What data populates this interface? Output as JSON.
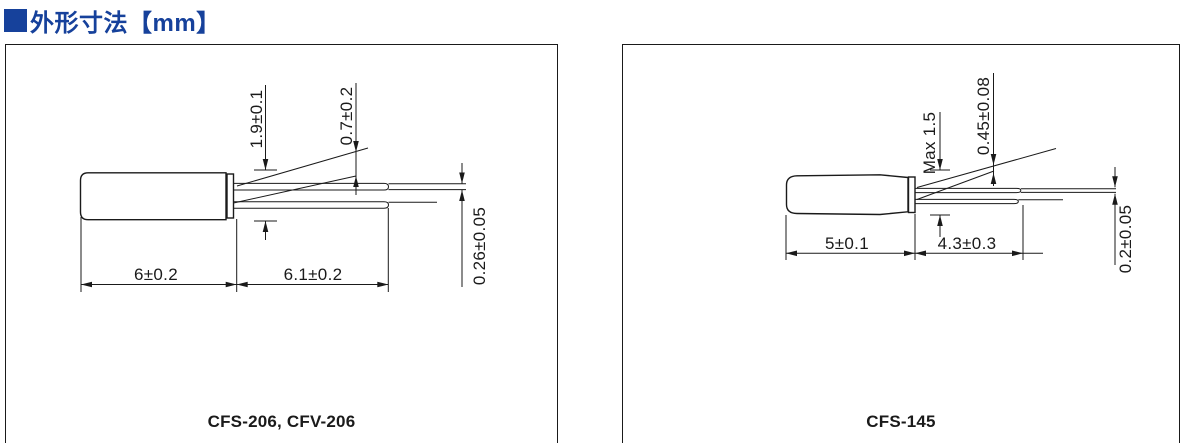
{
  "header": {
    "title": "外形寸法【mm】",
    "accent_color": "#16419b"
  },
  "icons": {
    "section_marker": "filled-blue-square"
  },
  "panels": [
    {
      "caption": "CFS-206, CFV-206",
      "dims": {
        "seal_height": "1.9±0.1",
        "lead_diameter": "0.7±0.2",
        "lead_thickness": "0.26±0.05",
        "body_length": "6±0.2",
        "lead_length": "6.1±0.2"
      }
    },
    {
      "caption": "CFS-145",
      "dims": {
        "seal_height": "Max 1.5",
        "lead_diameter": "0.45±0.08",
        "lead_thickness": "0.2±0.05",
        "body_length": "5±0.1",
        "lead_length": "4.3±0.3"
      }
    }
  ]
}
